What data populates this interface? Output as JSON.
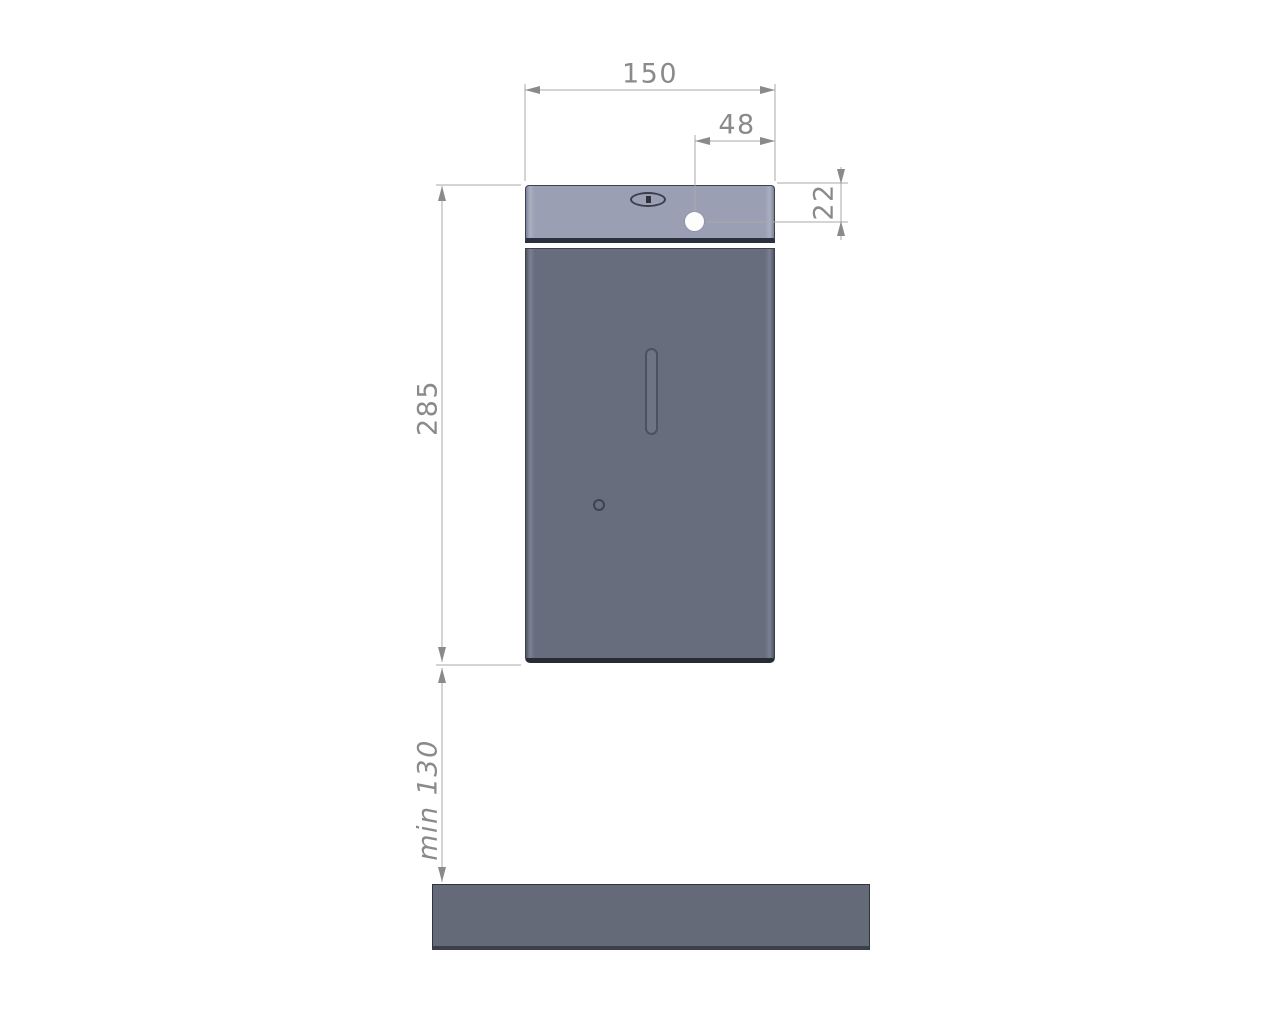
{
  "colors": {
    "lid": "#9b9fb3",
    "body": "#676d7d",
    "counter": "#646a77",
    "outline": "#3c4150",
    "dim_line": "#a8a8a8",
    "dim_text": "#8a8a8a",
    "hole": "#fdfdfd"
  },
  "dimensions": {
    "overall_width": "150",
    "hole_offset_from_edge": "48",
    "hole_offset_from_top": "22",
    "body_height": "285",
    "mounting_clearance": "min 130"
  }
}
